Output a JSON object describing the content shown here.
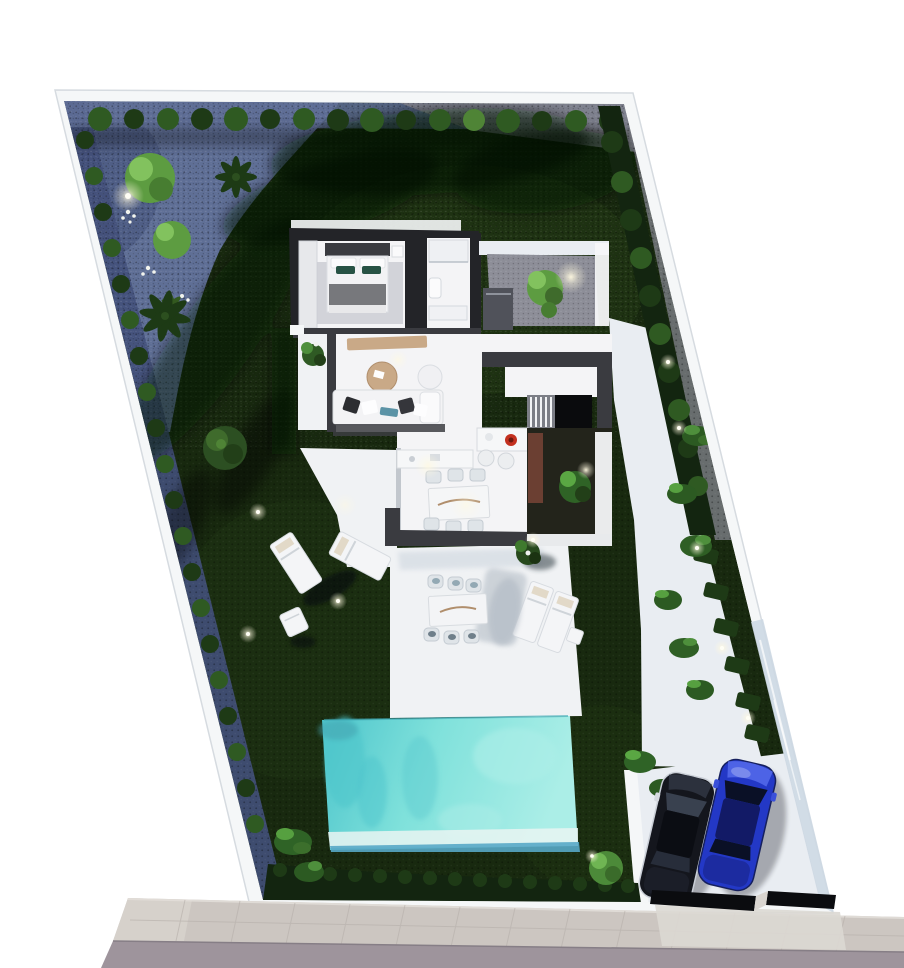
{
  "scene": {
    "kind": "Aerial 3D architectural render of a villa plot with garden, swimming pool, terrace and two-car parking",
    "rooms": [
      "bedroom",
      "bathroom",
      "living room",
      "kitchen-dining",
      "stairs",
      "patio courtyard",
      "interior courtyard"
    ],
    "cars": [
      {
        "name": "dark car"
      },
      {
        "name": "blue car"
      }
    ],
    "counts": {
      "pools": 1,
      "sun_loungers": 4,
      "indoor_dining_chairs": 6,
      "outdoor_dining_chairs": 6,
      "perimeter_bushes_top_row": 16
    }
  },
  "colors": {
    "page_bg": "#ffffff",
    "wall_white": "#f5f7f8",
    "wall_shade": "#d6dbe0",
    "wall_glass": "#cdd8e3",
    "lawn_dark": "#18290f",
    "lawn_mid": "#243c16",
    "hedge_dark": "#132510",
    "bush_green": "#2f5a22",
    "bush_mid": "#1e3a16",
    "bush_light": "#4f8436",
    "tree_bright": "#5d9c41",
    "tree_light": "#82c25e",
    "palm_dark": "#1d3a15",
    "gravel_blue": "#5f6f96",
    "gravel_blue_dark": "#42507a",
    "gravel_gray": "#83848f",
    "path_white": "#e9edf2",
    "terrace_white": "#f0f2f4",
    "pool_base": "#7fe1db",
    "pool_light": "#abeee7",
    "pool_dark": "#4cc4cb",
    "pool_edge": "#58a8c6",
    "roof_dark": "#3a3b40",
    "wall_int_dark": "#232428",
    "patio_gray": "#8d8e98",
    "floor_white": "#f4f4f6",
    "rug_gray": "#cbcdd3",
    "wood_tan": "#c9a987",
    "teal_pillow": "#5b93a6",
    "blanket_gray": "#77787c",
    "pillow_green": "#275244",
    "brick": "#6b3f32",
    "sidewalk": "#ccc6c1",
    "sidewalk_line": "#b8b1ac",
    "road": "#9e949c",
    "car_dark_body": "#14161d",
    "car_trim": "#c9ced6",
    "car_blue_body": "#2338c6",
    "car_blue_roof": "#121a66",
    "car_window": "#0a1026",
    "red_pot": "#c3301f",
    "glow": "#fff9e0"
  }
}
